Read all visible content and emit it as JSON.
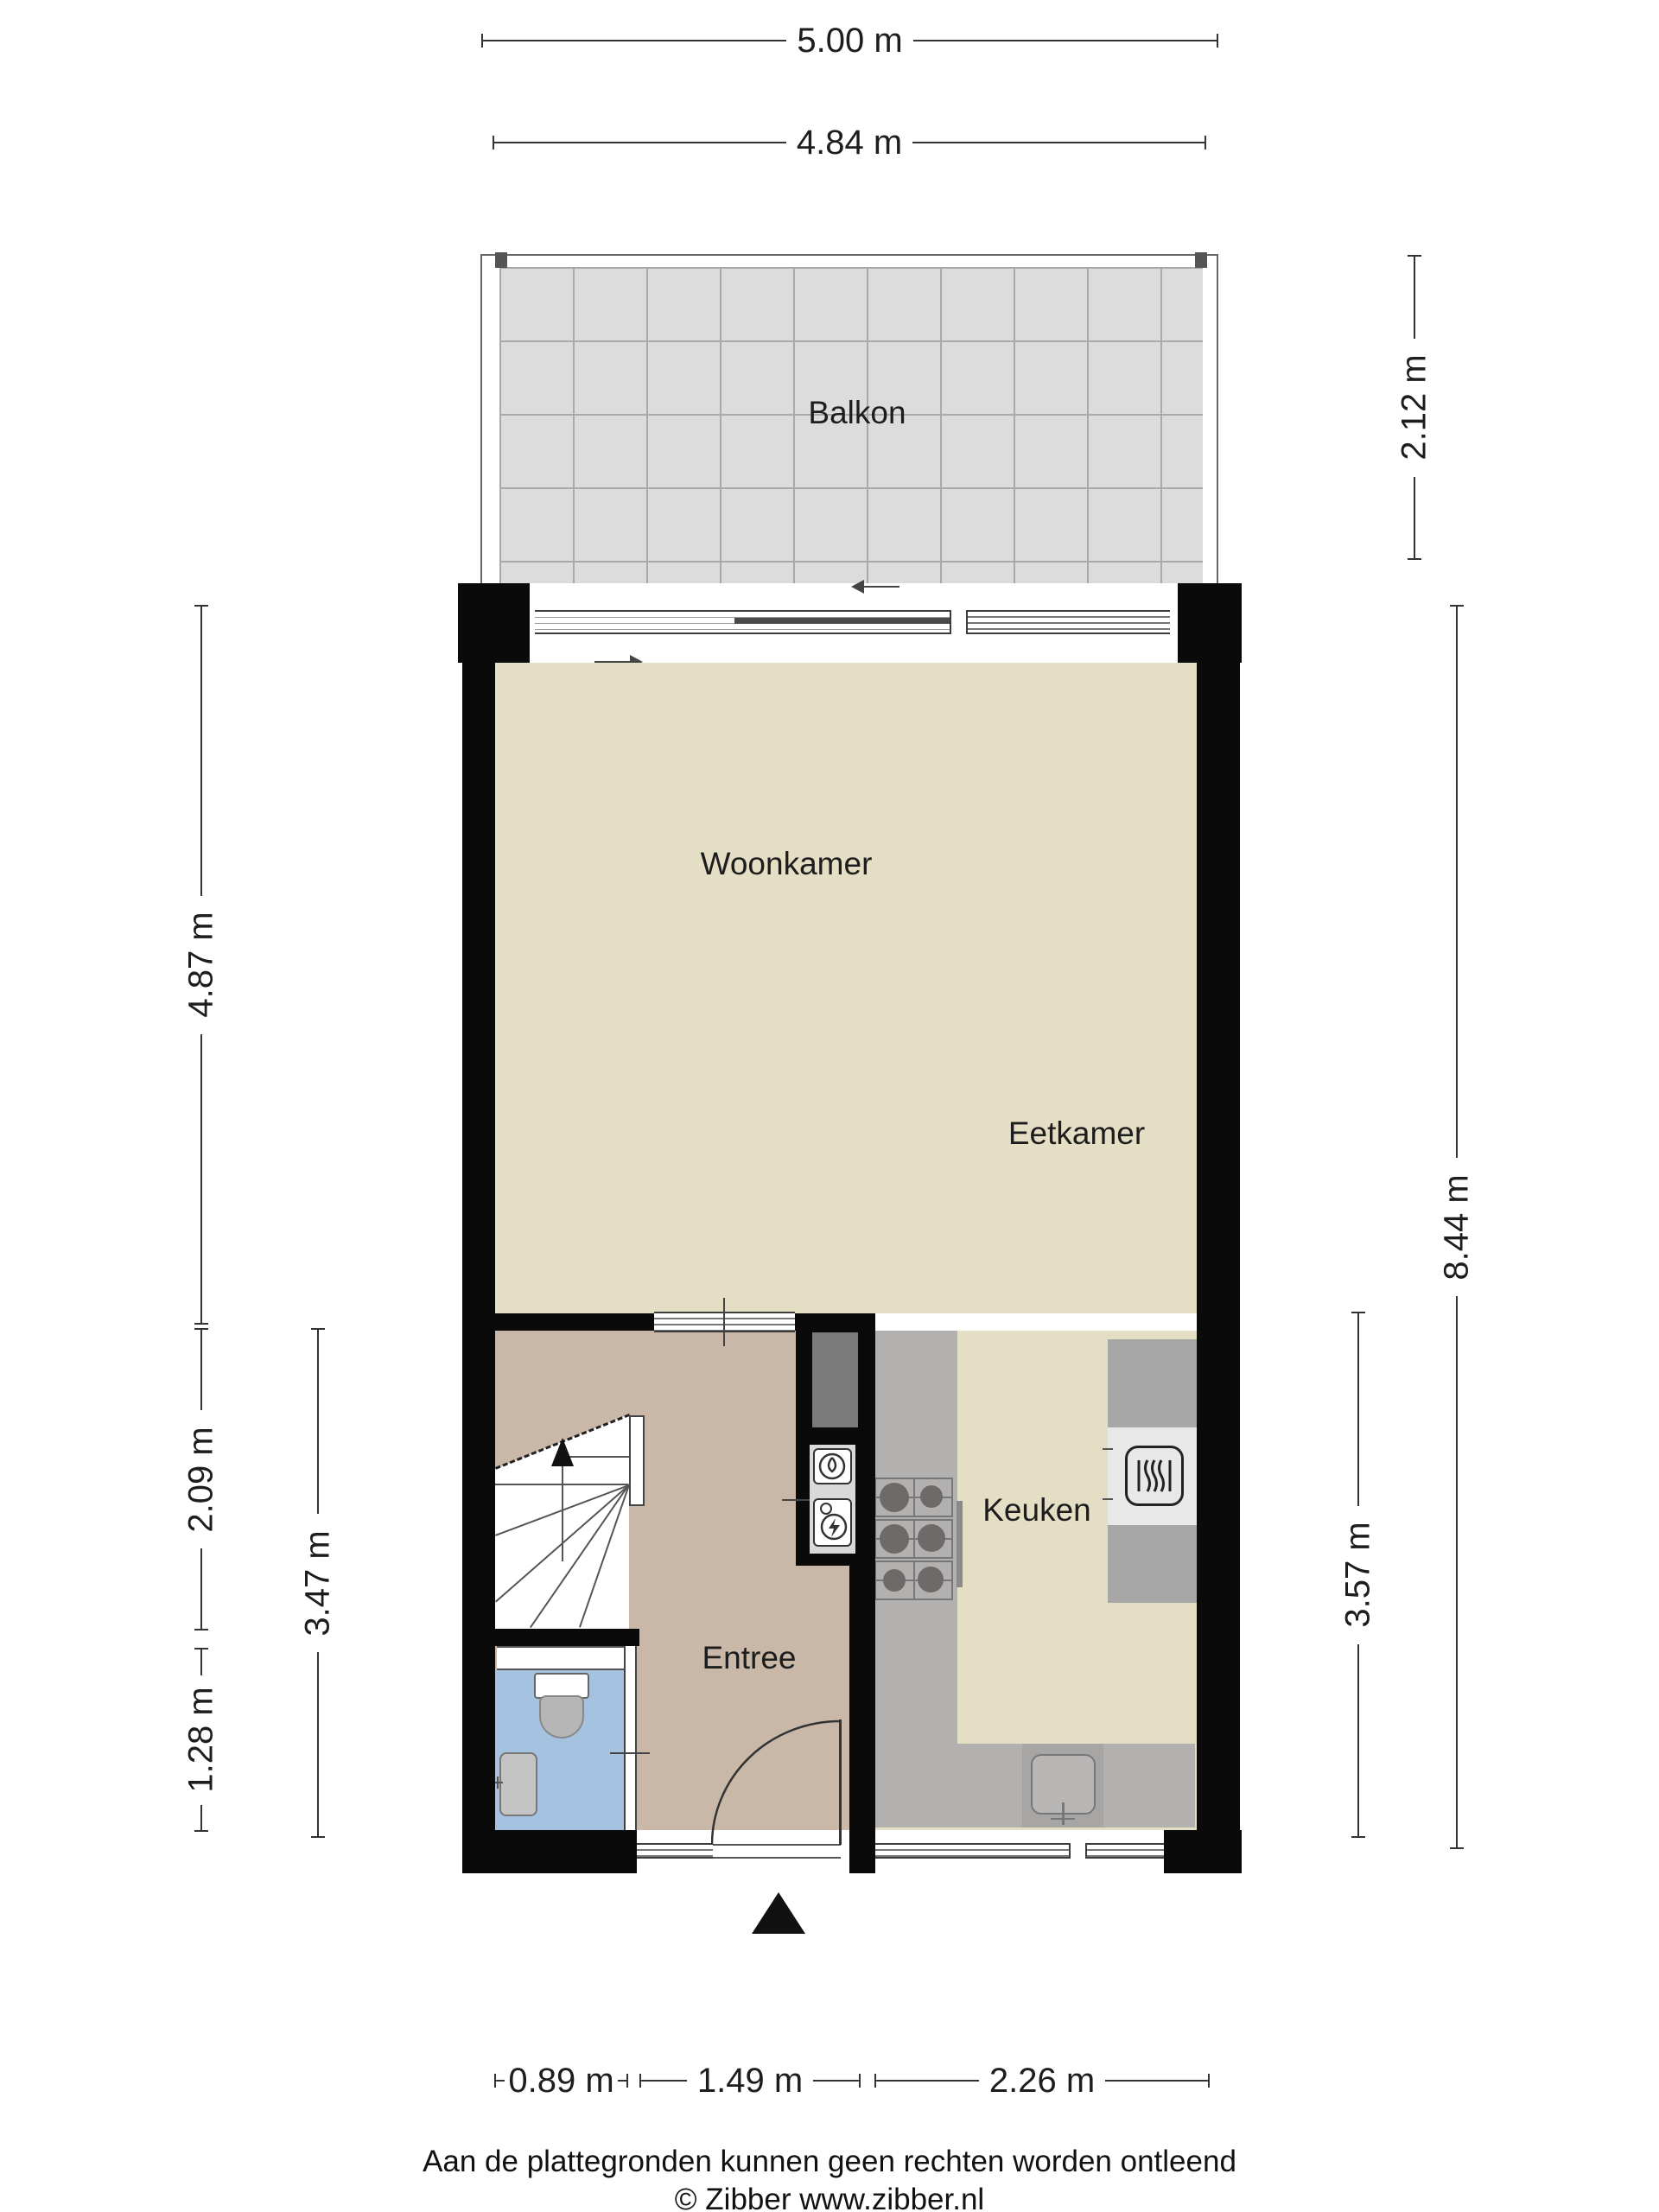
{
  "rooms": {
    "balkon": {
      "label": "Balkon"
    },
    "woonkamer": {
      "label": "Woonkamer"
    },
    "eetkamer": {
      "label": "Eetkamer"
    },
    "keuken": {
      "label": "Keuken"
    },
    "entree": {
      "label": "Entree"
    }
  },
  "dimensions": {
    "top_outer": {
      "label": "5.00 m"
    },
    "top_inner": {
      "label": "4.84 m"
    },
    "balcony_depth": {
      "label": "2.12 m"
    },
    "living_height": {
      "label": "4.87 m"
    },
    "right_total": {
      "label": "8.44 m"
    },
    "stairs_zone": {
      "label": "2.09 m"
    },
    "bath_zone": {
      "label": "1.28 m"
    },
    "left_inner_total": {
      "label": "3.47 m"
    },
    "kitchen_height": {
      "label": "3.57 m"
    },
    "bottom_bath": {
      "label": "0.89 m"
    },
    "bottom_entree": {
      "label": "1.49 m"
    },
    "bottom_kitchen": {
      "label": "2.26 m"
    }
  },
  "footer": {
    "disclaimer": "Aan de plattegronden kunnen geen rechten worden ontleend",
    "copyright": "© Zibber www.zibber.nl"
  },
  "colors": {
    "wall": "#0a0a0a",
    "floor_main": "#e4dec4",
    "floor_entree": "#c9b8a8",
    "floor_bath": "#a6c2e1",
    "balcony_tile": "#dcdcdc",
    "balcony_grid": "#a9a9a9",
    "counter": "#b3b0b0",
    "counter_dark": "#a7a7a7",
    "counter_light": "#e8e8e8",
    "shaft": "#7a7a7a",
    "closet": "#d9d9d9",
    "line": "#333333"
  }
}
